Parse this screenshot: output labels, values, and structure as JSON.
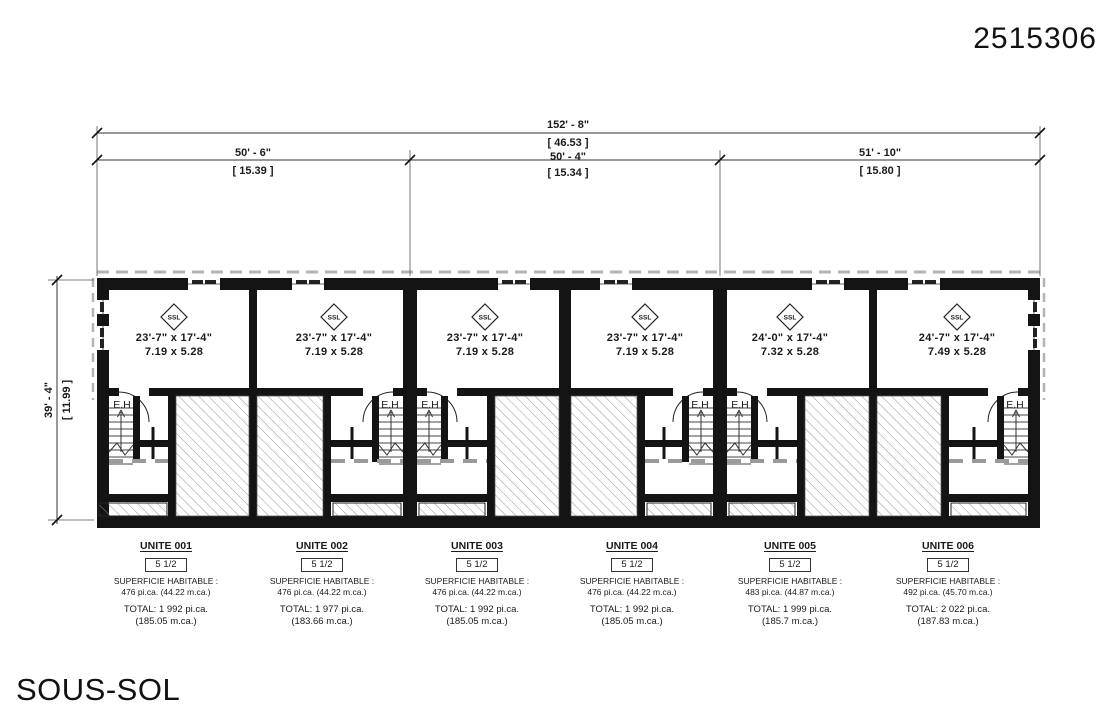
{
  "drawing_number": "2515306",
  "floor_title": "SOUS-SOL",
  "room_tag": "SSL",
  "stair_label": "E.H",
  "dimensions": {
    "overall_imperial": "152' - 8\"",
    "overall_metric": "[ 46.53 ]",
    "depth_imperial": "39' - 4\"",
    "depth_metric": "[ 11.99 ]",
    "segments": [
      {
        "imperial": "50' - 6\"",
        "metric": "[ 15.39 ]"
      },
      {
        "imperial": "50' - 4\"",
        "metric": "[ 15.34 ]"
      },
      {
        "imperial": "51' - 10\"",
        "metric": "[ 15.80 ]"
      }
    ]
  },
  "units": [
    {
      "name": "UNITE 001",
      "type": "5 1/2",
      "superficie_label": "SUPERFICIE HABITABLE :",
      "area": "476 pi.ca. (44.22 m.ca.)",
      "total": "TOTAL: 1 992 pi.ca.",
      "total_metric": "(185.05 m.ca.)",
      "room_imperial": "23'-7\" x 17'-4\"",
      "room_metric": "7.19 x 5.28"
    },
    {
      "name": "UNITE 002",
      "type": "5 1/2",
      "superficie_label": "SUPERFICIE HABITABLE :",
      "area": "476 pi.ca. (44.22 m.ca.)",
      "total": "TOTAL: 1 977 pi.ca.",
      "total_metric": "(183.66 m.ca.)",
      "room_imperial": "23'-7\" x 17'-4\"",
      "room_metric": "7.19 x 5.28"
    },
    {
      "name": "UNITE 003",
      "type": "5 1/2",
      "superficie_label": "SUPERFICIE HABITABLE :",
      "area": "476 pi.ca. (44.22 m.ca.)",
      "total": "TOTAL: 1 992 pi.ca.",
      "total_metric": "(185.05 m.ca.)",
      "room_imperial": "23'-7\" x 17'-4\"",
      "room_metric": "7.19 x 5.28"
    },
    {
      "name": "UNITE 004",
      "type": "5 1/2",
      "superficie_label": "SUPERFICIE HABITABLE :",
      "area": "476 pi.ca. (44.22 m.ca.)",
      "total": "TOTAL: 1 992 pi.ca.",
      "total_metric": "(185.05 m.ca.)",
      "room_imperial": "23'-7\" x 17'-4\"",
      "room_metric": "7.19 x 5.28"
    },
    {
      "name": "UNITE 005",
      "type": "5 1/2",
      "superficie_label": "SUPERFICIE HABITABLE :",
      "area": "483 pi.ca. (44.87 m.ca.)",
      "total": "TOTAL: 1 999 pi.ca.",
      "total_metric": "(185.7 m.ca.)",
      "room_imperial": "24'-0\" x 17'-4\"",
      "room_metric": "7.32 x 5.28"
    },
    {
      "name": "UNITE 006",
      "type": "5 1/2",
      "superficie_label": "SUPERFICIE HABITABLE :",
      "area": "492 pi.ca. (45.70 m.ca.)",
      "total": "TOTAL: 2 022 pi.ca.",
      "total_metric": "(187.83 m.ca.)",
      "room_imperial": "24'-7\" x 17'-4\"",
      "room_metric": "7.49 x 5.28"
    }
  ]
}
